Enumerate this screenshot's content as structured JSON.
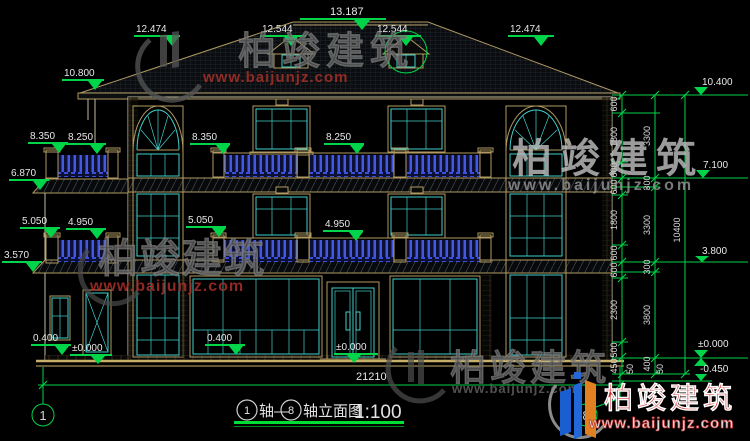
{
  "drawing": {
    "title": {
      "axis_from": "1",
      "axis_to": "8",
      "connector": "轴—",
      "suffix": "轴立面图",
      "scale": "1:100"
    },
    "levels_top": {
      "l_outer": "12.474",
      "l_dormer": "12.544",
      "ridge": "13.187",
      "r_dormer": "12.544",
      "r_outer": "12.474"
    },
    "levels_left": {
      "eave": "10.800",
      "f3_a": "8.350",
      "f3_b": "8.250",
      "wing_eave": "6.870",
      "f2_a": "5.050",
      "f2_b": "4.950",
      "wing_band": "3.570",
      "porch": "0.400",
      "ground": "±0.000"
    },
    "levels_mid": {
      "f3_a": "8.350",
      "f3_b": "8.250",
      "f2_a": "5.050",
      "f2_b": "4.950",
      "porch": "0.400",
      "ground": "±0.000"
    },
    "levels_right": {
      "eave": "10.400",
      "f3": "7.100",
      "f2": "3.800",
      "ground": "±0.000",
      "below": "-0.450"
    },
    "dims_right_inner": [
      "600",
      "1800",
      "600",
      "600",
      "1800",
      "600",
      "600",
      "2300",
      "500",
      "450"
    ],
    "dims_right_mid": [
      "3300",
      "300",
      "3300",
      "300",
      "3800",
      "400"
    ],
    "dims_right_outer": [
      "10400"
    ],
    "dims_right_small": [
      "50",
      "50"
    ],
    "dim_bottom_total": "21210",
    "axis_left": "1",
    "axis_right": "8"
  },
  "watermark": {
    "brand": "柏竣建筑",
    "url": "www.baijunjz.com"
  },
  "logo": {
    "brand": "柏竣建筑",
    "url": "www.baijunjz.com"
  },
  "colors": {
    "dim_green": "#00d448",
    "window_cyan": "#3fd0cc",
    "frame_tan": "#b09a62",
    "railing_blue": "#3a4fd0",
    "brand_red": "#cc2525",
    "background": "#000000"
  }
}
